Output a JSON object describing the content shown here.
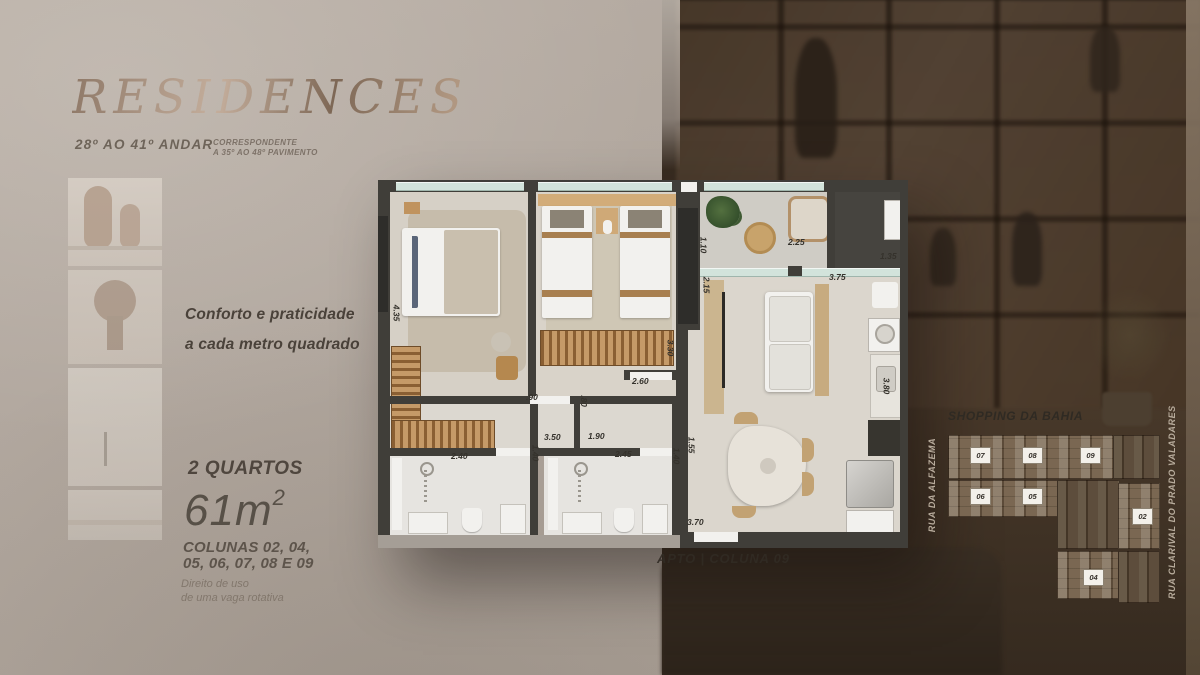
{
  "brand": {
    "title": "RESIDENCES",
    "floors": "28º AO 41º ANDAR",
    "note_line1": "CORRESPONDENTE",
    "note_line2": "A 35º AO 48º PAVIMENTO"
  },
  "left_panel": {
    "tagline_line1": "Conforto e praticidade",
    "tagline_line2": "a cada metro quadrado",
    "unit_type": "2 QUARTOS",
    "area": "61m",
    "area_exp": "2",
    "columns_line1": "COLUNAS 02, 04,",
    "columns_line2": "05, 06, 07, 08 E 09",
    "parking_line1": "Direito de uso",
    "parking_line2": "de uma vaga rotativa"
  },
  "floorplan": {
    "caption": "APTO | COLUNA 09",
    "measurements": [
      {
        "t": "4.35",
        "x": 10,
        "y": 128,
        "r": 1
      },
      {
        "t": "1.10",
        "x": 317,
        "y": 60,
        "r": 1
      },
      {
        "t": "2.25",
        "x": 410,
        "y": 57,
        "r": 0
      },
      {
        "t": "1.35",
        "x": 502,
        "y": 71,
        "r": 0
      },
      {
        "t": "3.75",
        "x": 451,
        "y": 92,
        "r": 0
      },
      {
        "t": "2.15",
        "x": 320,
        "y": 100,
        "r": 1
      },
      {
        "t": "3.30",
        "x": 284,
        "y": 163,
        "r": 1
      },
      {
        "t": "2.60",
        "x": 254,
        "y": 196,
        "r": 0
      },
      {
        "t": ".90",
        "x": 148,
        "y": 212,
        "r": 0
      },
      {
        "t": ".80",
        "x": 200,
        "y": 216,
        "r": 1
      },
      {
        "t": "3.50",
        "x": 166,
        "y": 252,
        "r": 0
      },
      {
        "t": "1.90",
        "x": 210,
        "y": 251,
        "r": 0
      },
      {
        "t": "2.40",
        "x": 73,
        "y": 271,
        "r": 0
      },
      {
        "t": "1.40",
        "x": 149,
        "y": 268,
        "r": 1
      },
      {
        "t": "2.45",
        "x": 237,
        "y": 269,
        "r": 0
      },
      {
        "t": "1.55",
        "x": 305,
        "y": 260,
        "r": 1
      },
      {
        "t": "1.40",
        "x": 290,
        "y": 271,
        "r": 1
      },
      {
        "t": "3.70",
        "x": 309,
        "y": 337,
        "r": 0
      },
      {
        "t": "3.80",
        "x": 500,
        "y": 201,
        "r": 1
      }
    ]
  },
  "keyplan": {
    "title": "SHOPPING DA BAHIA",
    "street_left": "RUA DA ALFAZEMA",
    "street_right": "RUA CLARIVAL DO PRADO VALADARES",
    "units": [
      {
        "label": "07",
        "x": 55,
        "y": 52
      },
      {
        "label": "08",
        "x": 107,
        "y": 52
      },
      {
        "label": "09",
        "x": 165,
        "y": 52
      },
      {
        "label": "06",
        "x": 55,
        "y": 93
      },
      {
        "label": "05",
        "x": 107,
        "y": 93
      },
      {
        "label": "02",
        "x": 217,
        "y": 113
      },
      {
        "label": "04",
        "x": 168,
        "y": 174
      }
    ]
  },
  "colors": {
    "bg_left": "#b2a89f",
    "bg_right": "#3f3125",
    "wall": "#403e39",
    "glass": "#d2e3db",
    "wood": "#c0935e",
    "title_bronze": "#b09781"
  }
}
